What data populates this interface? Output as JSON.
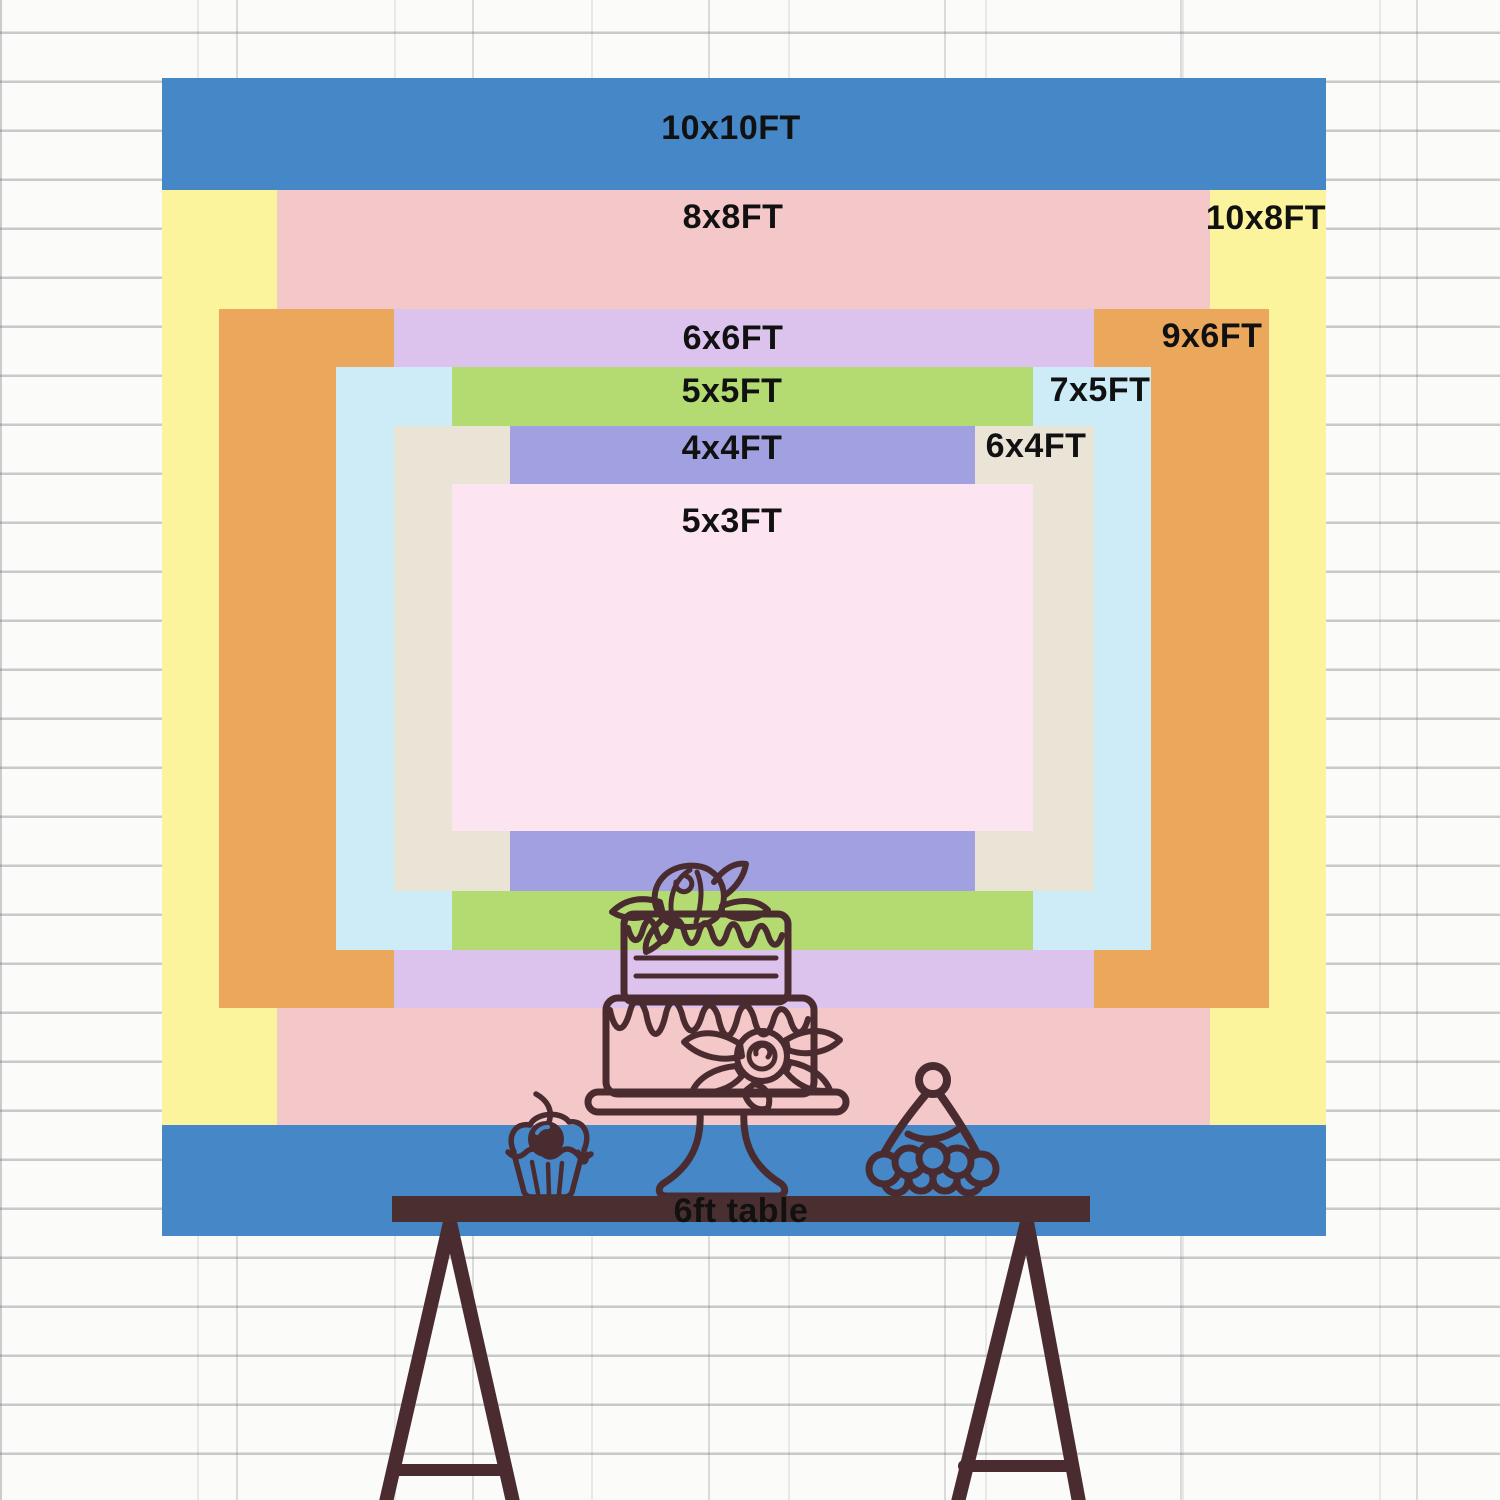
{
  "colors": {
    "text": "#111111",
    "ink": "#4a2c30",
    "table_wood": "#4a2f30",
    "wall": "#fbfbfa"
  },
  "sizes": [
    {
      "id": "10x10",
      "label": "10x10FT",
      "width_ft": 10,
      "height_ft": 10,
      "color": "#4587c7"
    },
    {
      "id": "10x8",
      "label": "10x8FT",
      "width_ft": 10,
      "height_ft": 8,
      "color": "#fbf49c"
    },
    {
      "id": "8x8",
      "label": "8x8FT",
      "width_ft": 8,
      "height_ft": 8,
      "color": "#f4c7c8"
    },
    {
      "id": "9x6",
      "label": "9x6FT",
      "width_ft": 9,
      "height_ft": 6,
      "color": "#eba85c"
    },
    {
      "id": "6x6",
      "label": "6x6FT",
      "width_ft": 6,
      "height_ft": 6,
      "color": "#dcc3ee"
    },
    {
      "id": "7x5",
      "label": "7x5FT",
      "width_ft": 7,
      "height_ft": 5,
      "color": "#cdecf7"
    },
    {
      "id": "5x5",
      "label": "5x5FT",
      "width_ft": 5,
      "height_ft": 5,
      "color": "#b4db72"
    },
    {
      "id": "6x4",
      "label": "6x4FT",
      "width_ft": 6,
      "height_ft": 4,
      "color": "#eae4d7"
    },
    {
      "id": "4x4",
      "label": "4x4FT",
      "width_ft": 4,
      "height_ft": 4,
      "color": "#a1a1e1"
    },
    {
      "id": "5x3",
      "label": "5x3FT",
      "width_ft": 5,
      "height_ft": 3,
      "color": "#fce4f0"
    }
  ],
  "table": {
    "label": "6ft table"
  }
}
